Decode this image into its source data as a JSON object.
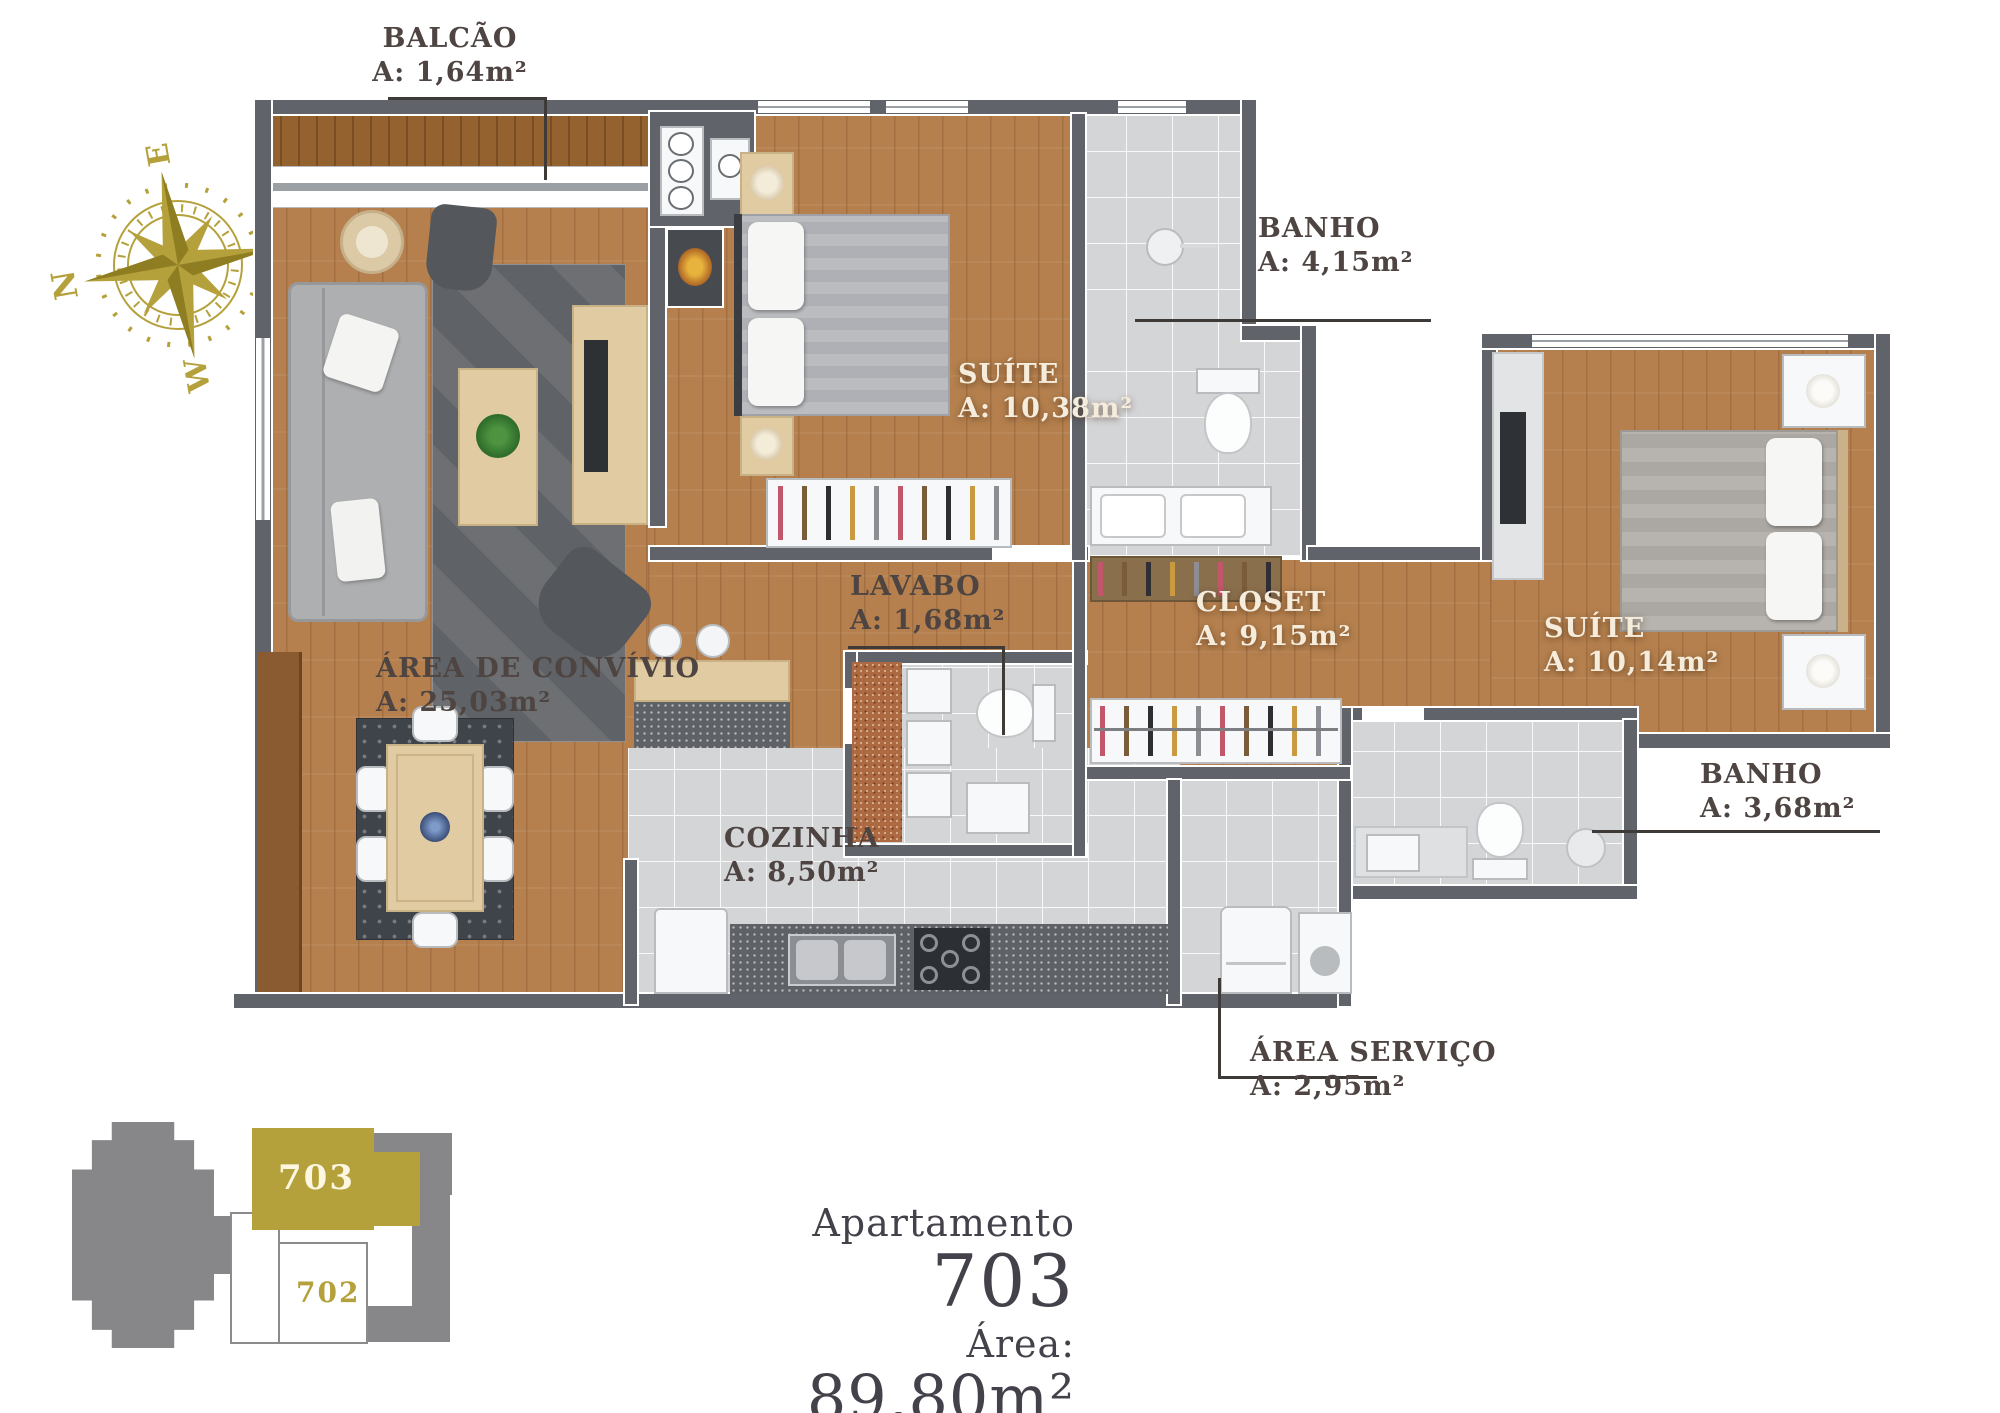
{
  "labels": {
    "balcao": {
      "name": "BALCÃO",
      "area": "A: 1,64m²"
    },
    "banho1": {
      "name": "BANHO",
      "area": "A: 4,15m²"
    },
    "suite1": {
      "name": "SUÍTE",
      "area": "A: 10,38m²"
    },
    "lavabo": {
      "name": "LAVABO",
      "area": "A: 1,68m²"
    },
    "closet": {
      "name": "CLOSET",
      "area": "A: 9,15m²"
    },
    "suite2": {
      "name": "SUÍTE",
      "area": "A: 10,14m²"
    },
    "banho2": {
      "name": "BANHO",
      "area": "A: 3,68m²"
    },
    "convivio": {
      "name": "ÁREA DE CONVÍVIO",
      "area": "A: 25,03m²"
    },
    "cozinha": {
      "name": "COZINHA",
      "area": "A: 8,50m²"
    },
    "servico": {
      "name": "ÁREA SERVIÇO",
      "area": "A: 2,95m²"
    }
  },
  "title": {
    "prefix": "Apartamento",
    "number": "703",
    "area_label": "Área:",
    "area_value": "89,80m²"
  },
  "compass": {
    "n": "N",
    "e": "E",
    "s": "S",
    "w": "W"
  },
  "keyplan": {
    "highlight": "703",
    "other": "702"
  },
  "colors": {
    "gold": "#b5a13c",
    "wall": "#60646a",
    "wood": "#b5804e",
    "tile": "#d4d5d7",
    "label_dark": "#4e4542",
    "label_light": "#f6ecdc",
    "title": "#45414a"
  }
}
